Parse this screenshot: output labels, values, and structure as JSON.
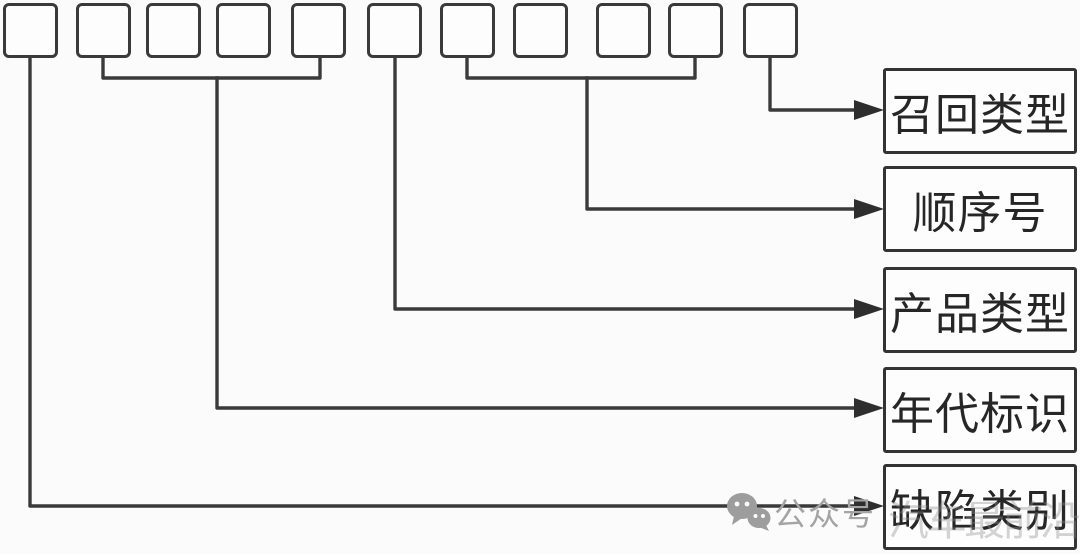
{
  "diagram": {
    "type": "code-structure-diagram",
    "code_boxes": {
      "count": 11
    },
    "labels": [
      {
        "id": "recall-type",
        "text": "召回类型",
        "box_range": "11"
      },
      {
        "id": "sequence-number",
        "text": "顺序号",
        "box_range": "7-10"
      },
      {
        "id": "product-type",
        "text": "产品类型",
        "box_range": "6"
      },
      {
        "id": "era-mark",
        "text": "年代标识",
        "box_range": "2-5"
      },
      {
        "id": "defect-category",
        "text": "缺陷类别",
        "box_range": "1"
      }
    ],
    "colors": {
      "line": "#3a3a3a",
      "box_border": "#333333",
      "text": "#262626",
      "background": "#fbfbfb",
      "watermark_gray": "#a4a4a4"
    }
  },
  "watermark": {
    "icon": "wechat-icon",
    "label": "公众号",
    "faint_text": "汽车最前沿"
  }
}
